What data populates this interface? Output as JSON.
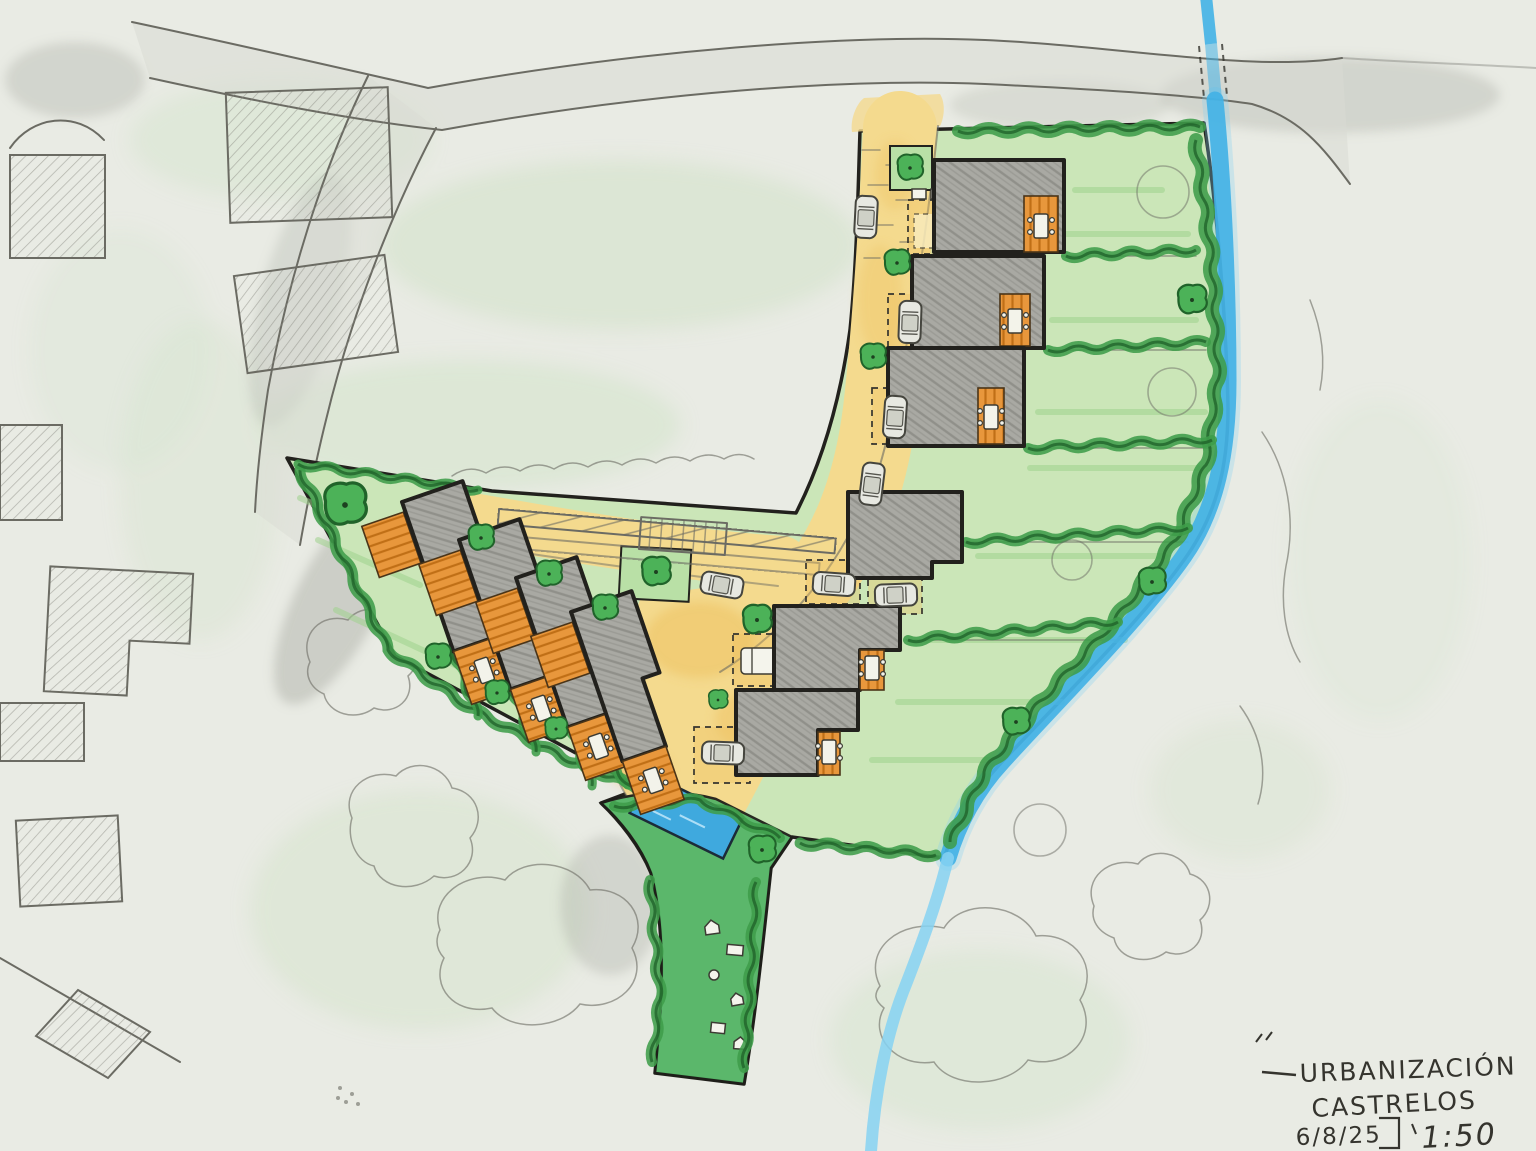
{
  "meta": {
    "description": "Hand-drawn urbanization site plan sketch, pencil and marker on paper"
  },
  "title_block": {
    "project_line1": "URBANIZACIÓN",
    "project_line2": "CASTRELOS",
    "date": "6/8/25",
    "scale": "1:50"
  },
  "palette": {
    "paper": "#e9ebe4",
    "wash_green": "#cfe2c6",
    "lawn": "#cbe6b8",
    "lawn_stripe": "#9ed18d",
    "path_green": "#55b567",
    "hedge": "#3f9d4a",
    "hedge_dark": "#20632a",
    "tree": "#4cb258",
    "road_yellow": "#f4da8e",
    "road_deep": "#edbf5e",
    "deck_orange": "#e8973c",
    "deck_stripe": "#c06f16",
    "building_gray": "#a9a9a3",
    "outline": "#22211d",
    "pencil": "#6b6b63",
    "water": "#43b2e6",
    "water_light": "#86d2f2",
    "pool": "#3fa9de",
    "car_body": "#e7e8e1",
    "ink": "#35342e"
  },
  "features": {
    "context": [
      "existing-road",
      "existing-side-road",
      "existing-buildings",
      "existing-trees",
      "stream",
      "culvert-crossing"
    ],
    "site": [
      "site-boundary",
      "lawn",
      "access-road",
      "private-lane",
      "parking-pads",
      "pergola",
      "terraced-houses-west",
      "detached-houses-east",
      "timber-decks",
      "patio-tables",
      "street-trees",
      "hedgerows",
      "swimming-pool",
      "greenway-path",
      "garden-furniture",
      "cars"
    ]
  },
  "counts": {
    "west_houses": 4,
    "east_houses": 6,
    "cars": 8,
    "parking_pads": 7,
    "swimming_pools": 1
  }
}
